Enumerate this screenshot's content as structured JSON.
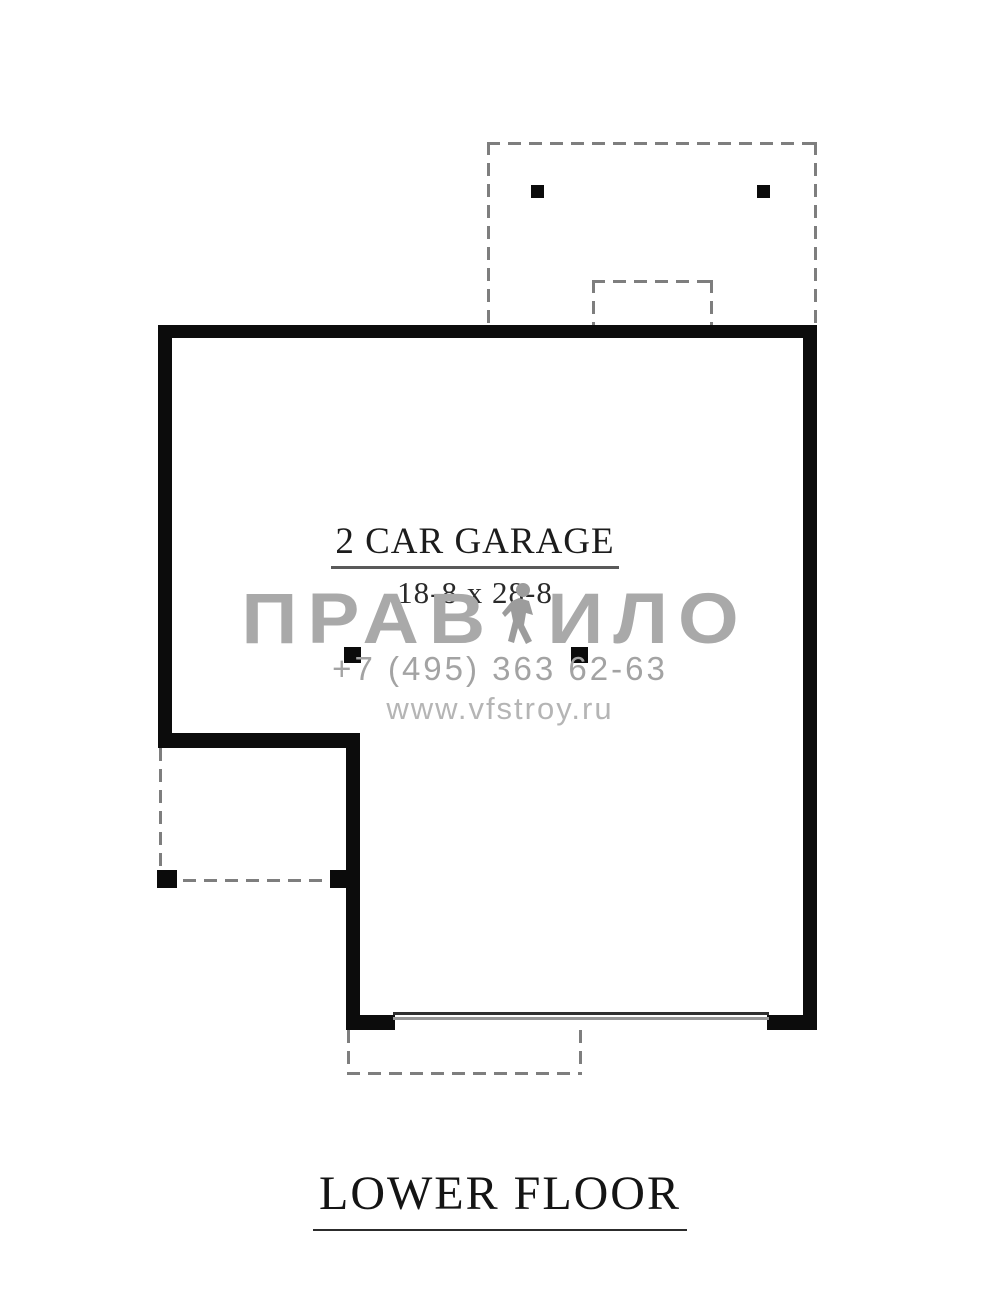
{
  "plan": {
    "room": {
      "label": "2 CAR GARAGE",
      "dimensions": "18-8 x 28-8"
    },
    "title": "LOWER FLOOR"
  },
  "watermark": {
    "brand_left": "ПРАВ",
    "brand_right": "ИЛО",
    "figure_icon": "person-logo-icon",
    "phone": "+7 (495) 363 62-63",
    "website": "www.vfstroy.ru"
  },
  "colors": {
    "wall": "#0c0c0c",
    "dashed_outline": "#7e7e7e",
    "watermark_text": "#a9a9a9",
    "phone_text": "#a3a3a3",
    "website_text": "#b5b5b5",
    "background": "#ffffff"
  }
}
